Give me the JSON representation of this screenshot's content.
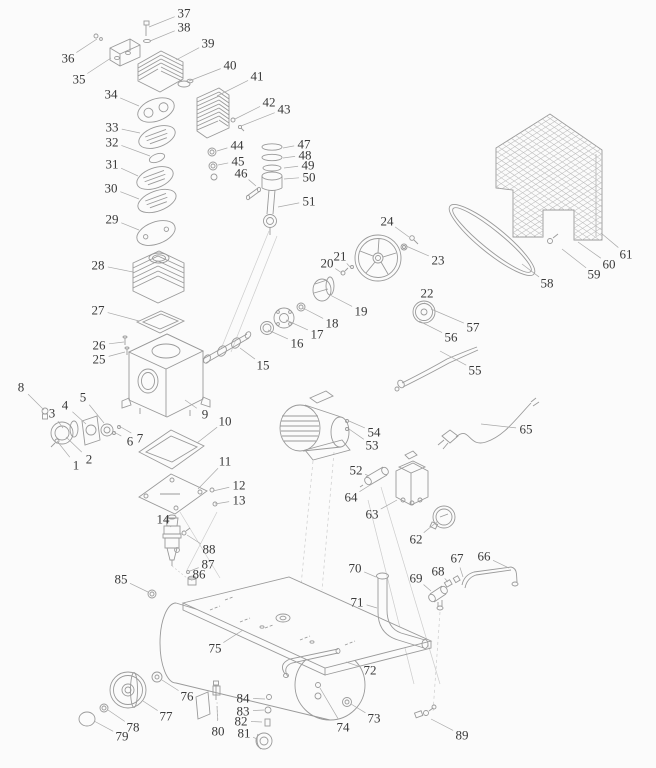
{
  "page": {
    "background": "#fbfbfb",
    "line_color": "#9a9a9a",
    "leader_color": "#a9a9a9",
    "label_color": "#3a3a3a",
    "canvas": {
      "width": 656,
      "height": 768
    }
  },
  "diagram": {
    "type": "exploded-parts-diagram",
    "labels_visible": [
      "1",
      "2",
      "3",
      "4",
      "5",
      "6",
      "7",
      "8",
      "9",
      "10",
      "11",
      "12",
      "13",
      "14",
      "15",
      "16",
      "17",
      "18",
      "19",
      "20",
      "21",
      "22",
      "23",
      "24",
      "25",
      "26",
      "27",
      "28",
      "29",
      "30",
      "31",
      "32",
      "33",
      "34",
      "35",
      "36",
      "37",
      "38",
      "39",
      "40",
      "41",
      "42",
      "43",
      "44",
      "45",
      "46",
      "47",
      "48",
      "49",
      "50",
      "51",
      "52",
      "53",
      "54",
      "55",
      "56",
      "57",
      "58",
      "59",
      "60",
      "61",
      "62",
      "63",
      "64",
      "65",
      "66",
      "67",
      "68",
      "69",
      "70",
      "71",
      "72",
      "73",
      "74",
      "75",
      "76",
      "77",
      "78",
      "79",
      "80",
      "81",
      "82",
      "83",
      "84",
      "85",
      "86",
      "87",
      "88",
      "89"
    ],
    "parts": [
      {
        "id": "1",
        "x": 76,
        "y": 465,
        "tx": 57,
        "ty": 441
      },
      {
        "id": "2",
        "x": 89,
        "y": 459,
        "tx": 66,
        "ty": 437
      },
      {
        "id": "3",
        "x": 52,
        "y": 413,
        "tx": 63,
        "ty": 428
      },
      {
        "id": "4",
        "x": 65,
        "y": 405,
        "tx": 86,
        "ty": 424
      },
      {
        "id": "5",
        "x": 83,
        "y": 397,
        "tx": 104,
        "ty": 423
      },
      {
        "id": "6",
        "x": 130,
        "y": 441,
        "tx": 114,
        "ty": 432
      },
      {
        "id": "7",
        "x": 140,
        "y": 438,
        "tx": 119,
        "ty": 426
      },
      {
        "id": "8",
        "x": 21,
        "y": 387,
        "tx": 44,
        "ty": 410
      },
      {
        "id": "9",
        "x": 205,
        "y": 414,
        "tx": 185,
        "ty": 400
      },
      {
        "id": "10",
        "x": 225,
        "y": 421,
        "tx": 197,
        "ty": 443
      },
      {
        "id": "11",
        "x": 225,
        "y": 461,
        "tx": 198,
        "ty": 489
      },
      {
        "id": "12",
        "x": 239,
        "y": 485,
        "tx": 213,
        "ty": 491
      },
      {
        "id": "13",
        "x": 239,
        "y": 500,
        "tx": 215,
        "ty": 504
      },
      {
        "id": "14",
        "x": 163,
        "y": 519,
        "tx": 171,
        "ty": 527
      },
      {
        "id": "15",
        "x": 263,
        "y": 365,
        "tx": 240,
        "ty": 348
      },
      {
        "id": "16",
        "x": 297,
        "y": 343,
        "tx": 268,
        "ty": 330
      },
      {
        "id": "17",
        "x": 317,
        "y": 334,
        "tx": 286,
        "ty": 320
      },
      {
        "id": "18",
        "x": 332,
        "y": 323,
        "tx": 303,
        "ty": 308
      },
      {
        "id": "19",
        "x": 361,
        "y": 311,
        "tx": 330,
        "ty": 295
      },
      {
        "id": "20",
        "x": 327,
        "y": 263,
        "tx": 342,
        "ty": 273
      },
      {
        "id": "21",
        "x": 340,
        "y": 256,
        "tx": 351,
        "ty": 268
      },
      {
        "id": "22",
        "x": 427,
        "y": 293,
        "tx": 424,
        "ty": 304
      },
      {
        "id": "23",
        "x": 438,
        "y": 260,
        "tx": 406,
        "ty": 246
      },
      {
        "id": "24",
        "x": 387,
        "y": 221,
        "tx": 409,
        "ty": 237
      },
      {
        "id": "25",
        "x": 99,
        "y": 359,
        "tx": 125,
        "ty": 352
      },
      {
        "id": "26",
        "x": 99,
        "y": 345,
        "tx": 124,
        "ty": 342
      },
      {
        "id": "27",
        "x": 98,
        "y": 310,
        "tx": 139,
        "ty": 321
      },
      {
        "id": "28",
        "x": 98,
        "y": 265,
        "tx": 133,
        "ty": 272
      },
      {
        "id": "29",
        "x": 112,
        "y": 219,
        "tx": 139,
        "ty": 230
      },
      {
        "id": "30",
        "x": 111,
        "y": 188,
        "tx": 139,
        "ty": 199
      },
      {
        "id": "31",
        "x": 112,
        "y": 164,
        "tx": 138,
        "ty": 176
      },
      {
        "id": "32",
        "x": 112,
        "y": 142,
        "tx": 150,
        "ty": 156
      },
      {
        "id": "33",
        "x": 112,
        "y": 127,
        "tx": 140,
        "ty": 133
      },
      {
        "id": "34",
        "x": 111,
        "y": 94,
        "tx": 139,
        "ty": 106
      },
      {
        "id": "35",
        "x": 79,
        "y": 79,
        "tx": 111,
        "ty": 58
      },
      {
        "id": "36",
        "x": 68,
        "y": 58,
        "tx": 97,
        "ty": 39
      },
      {
        "id": "37",
        "x": 184,
        "y": 13,
        "tx": 149,
        "ty": 27
      },
      {
        "id": "38",
        "x": 184,
        "y": 27,
        "tx": 150,
        "ty": 41
      },
      {
        "id": "39",
        "x": 208,
        "y": 43,
        "tx": 176,
        "ty": 60
      },
      {
        "id": "40",
        "x": 230,
        "y": 65,
        "tx": 189,
        "ty": 81
      },
      {
        "id": "41",
        "x": 257,
        "y": 76,
        "tx": 217,
        "ty": 96
      },
      {
        "id": "42",
        "x": 269,
        "y": 102,
        "tx": 235,
        "ty": 119
      },
      {
        "id": "43",
        "x": 284,
        "y": 109,
        "tx": 241,
        "ty": 126
      },
      {
        "id": "44",
        "x": 237,
        "y": 145,
        "tx": 217,
        "ty": 151
      },
      {
        "id": "45",
        "x": 238,
        "y": 161,
        "tx": 218,
        "ty": 165
      },
      {
        "id": "46",
        "x": 241,
        "y": 173,
        "tx": 256,
        "ty": 186
      },
      {
        "id": "47",
        "x": 304,
        "y": 144,
        "tx": 283,
        "ty": 148
      },
      {
        "id": "48",
        "x": 305,
        "y": 155,
        "tx": 283,
        "ty": 158
      },
      {
        "id": "49",
        "x": 308,
        "y": 165,
        "tx": 284,
        "ty": 168
      },
      {
        "id": "50",
        "x": 309,
        "y": 177,
        "tx": 284,
        "ty": 179
      },
      {
        "id": "51",
        "x": 309,
        "y": 201,
        "tx": 278,
        "ty": 207
      },
      {
        "id": "52",
        "x": 356,
        "y": 470,
        "tx": 369,
        "ty": 476
      },
      {
        "id": "53",
        "x": 372,
        "y": 445,
        "tx": 349,
        "ty": 429
      },
      {
        "id": "54",
        "x": 374,
        "y": 432,
        "tx": 349,
        "ty": 421
      },
      {
        "id": "55",
        "x": 475,
        "y": 370,
        "tx": 440,
        "ty": 351
      },
      {
        "id": "56",
        "x": 451,
        "y": 337,
        "tx": 419,
        "ty": 321
      },
      {
        "id": "57",
        "x": 473,
        "y": 327,
        "tx": 431,
        "ty": 309
      },
      {
        "id": "58",
        "x": 547,
        "y": 283,
        "tx": 522,
        "ty": 264
      },
      {
        "id": "59",
        "x": 594,
        "y": 274,
        "tx": 562,
        "ty": 249
      },
      {
        "id": "60",
        "x": 609,
        "y": 264,
        "tx": 578,
        "ty": 242
      },
      {
        "id": "61",
        "x": 626,
        "y": 254,
        "tx": 601,
        "ty": 233
      },
      {
        "id": "62",
        "x": 416,
        "y": 539,
        "tx": 438,
        "ty": 521
      },
      {
        "id": "63",
        "x": 372,
        "y": 514,
        "tx": 397,
        "ty": 500
      },
      {
        "id": "64",
        "x": 351,
        "y": 497,
        "tx": 375,
        "ty": 482
      },
      {
        "id": "65",
        "x": 526,
        "y": 429,
        "tx": 481,
        "ty": 424
      },
      {
        "id": "66",
        "x": 484,
        "y": 556,
        "tx": 509,
        "ty": 568
      },
      {
        "id": "67",
        "x": 457,
        "y": 558,
        "tx": 463,
        "ty": 577
      },
      {
        "id": "68",
        "x": 438,
        "y": 571,
        "tx": 448,
        "ty": 582
      },
      {
        "id": "69",
        "x": 416,
        "y": 578,
        "tx": 431,
        "ty": 591
      },
      {
        "id": "70",
        "x": 355,
        "y": 568,
        "tx": 376,
        "ty": 577
      },
      {
        "id": "71",
        "x": 357,
        "y": 602,
        "tx": 377,
        "ty": 608
      },
      {
        "id": "72",
        "x": 370,
        "y": 670,
        "tx": 346,
        "ty": 662
      },
      {
        "id": "73",
        "x": 374,
        "y": 718,
        "tx": 351,
        "ty": 704
      },
      {
        "id": "74",
        "x": 343,
        "y": 727,
        "tx": 320,
        "ty": 688
      },
      {
        "id": "75",
        "x": 215,
        "y": 648,
        "tx": 243,
        "ty": 630
      },
      {
        "id": "76",
        "x": 187,
        "y": 696,
        "tx": 162,
        "ty": 680
      },
      {
        "id": "77",
        "x": 166,
        "y": 716,
        "tx": 143,
        "ty": 701
      },
      {
        "id": "78",
        "x": 133,
        "y": 727,
        "tx": 108,
        "ty": 710
      },
      {
        "id": "79",
        "x": 122,
        "y": 736,
        "tx": 94,
        "ty": 721
      },
      {
        "id": "80",
        "x": 218,
        "y": 731,
        "tx": 217,
        "ty": 706
      },
      {
        "id": "81",
        "x": 244,
        "y": 733,
        "tx": 257,
        "ty": 739
      },
      {
        "id": "82",
        "x": 241,
        "y": 721,
        "tx": 262,
        "ty": 722
      },
      {
        "id": "83",
        "x": 243,
        "y": 711,
        "tx": 264,
        "ty": 710
      },
      {
        "id": "84",
        "x": 243,
        "y": 698,
        "tx": 265,
        "ty": 699
      },
      {
        "id": "85",
        "x": 121,
        "y": 579,
        "tx": 148,
        "ty": 592
      },
      {
        "id": "86",
        "x": 199,
        "y": 574,
        "tx": 192,
        "ty": 580
      },
      {
        "id": "87",
        "x": 208,
        "y": 564,
        "tx": 190,
        "ty": 571
      },
      {
        "id": "88",
        "x": 209,
        "y": 549,
        "tx": 187,
        "ty": 535
      },
      {
        "id": "89",
        "x": 462,
        "y": 735,
        "tx": 431,
        "ty": 719
      }
    ]
  }
}
